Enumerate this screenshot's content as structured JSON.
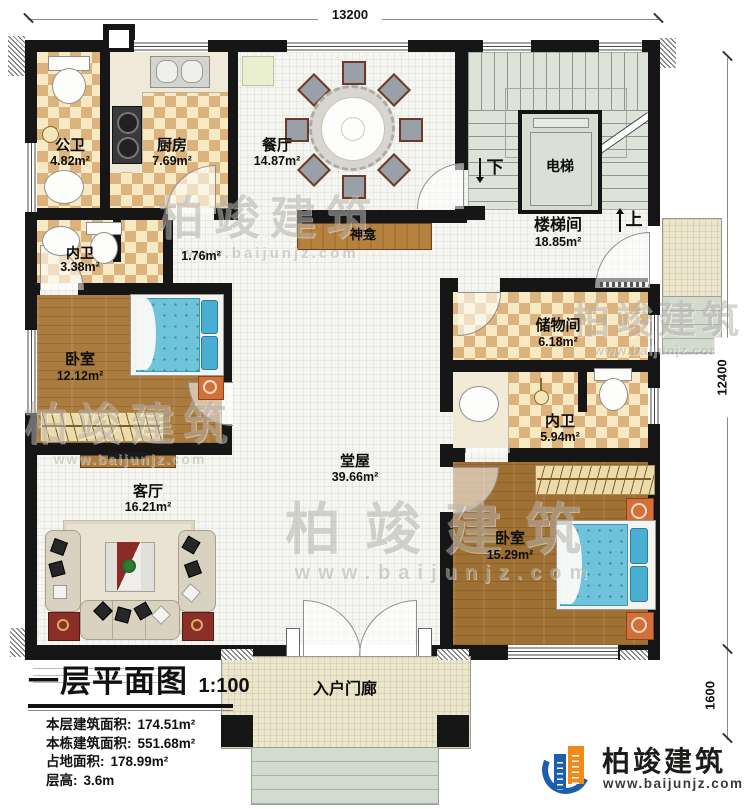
{
  "dims": {
    "width": "13200",
    "height": "12400",
    "porch_depth": "1600"
  },
  "rooms": [
    {
      "name": "公卫",
      "area": "4.82m²"
    },
    {
      "name": "厨房",
      "area": "7.69m²"
    },
    {
      "name": "餐厅",
      "area": "14.87m²"
    },
    {
      "name": "电梯",
      "area": ""
    },
    {
      "name": "楼梯间",
      "area": "18.85m²"
    },
    {
      "name": "内卫",
      "area": "3.38m²"
    },
    {
      "name": "神龛",
      "area": "1.76m²"
    },
    {
      "name": "卧室",
      "area": "12.12m²"
    },
    {
      "name": "储物间",
      "area": "6.18m²"
    },
    {
      "name": "内卫",
      "area": "5.94m²"
    },
    {
      "name": "堂屋",
      "area": "39.66m²"
    },
    {
      "name": "客厅",
      "area": "16.21m²"
    },
    {
      "name": "卧室",
      "area": "15.29m²"
    },
    {
      "name": "入户门廊",
      "area": ""
    }
  ],
  "stairs": {
    "down": "下",
    "up": "上"
  },
  "title_block": {
    "title": "一层平面图",
    "scale": "1:100",
    "stats": [
      {
        "label": "本层建筑面积:",
        "value": "174.51m²"
      },
      {
        "label": "本栋建筑面积:",
        "value": "551.68m²"
      },
      {
        "label": "占地面积:",
        "value": "178.99m²"
      },
      {
        "label": "层高:",
        "value": "3.6m"
      }
    ]
  },
  "brand": {
    "name": "柏竣建筑",
    "url": "www.baijunjz.com"
  },
  "watermark": {
    "name": "柏竣建筑",
    "url": "www.baijunjz.com"
  },
  "colors": {
    "wall": "#161616",
    "logo_blue": "#1c5fae",
    "logo_orange": "#f28a1b",
    "bed_blue": "#6fc4dc",
    "stair_green": "#dde3d8",
    "floor_checker": "#dcb37c"
  }
}
